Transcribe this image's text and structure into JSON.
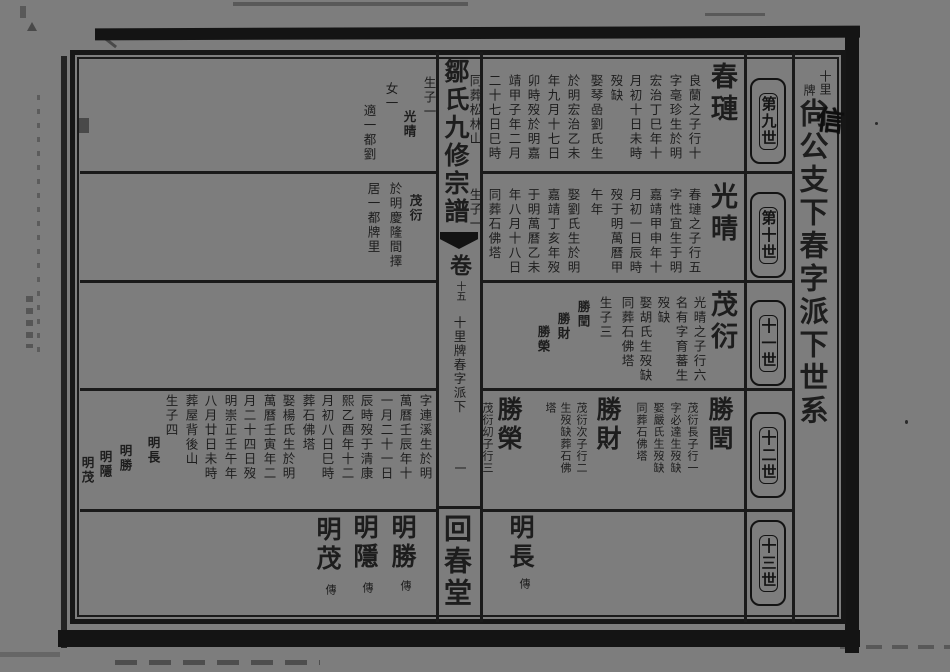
{
  "colors": {
    "paper": "#7d7d7d",
    "ink": "#1c1c1c"
  },
  "header": {
    "small_line1": "十里",
    "small_line2": "牌",
    "title": "尙公支下春字派下世系",
    "handwritten_note": "信"
  },
  "generation_labels": [
    "第九世",
    "第十世",
    "十一世",
    "十二世",
    "十三世"
  ],
  "fold": {
    "book_title": "鄒氏九修宗譜",
    "volume_label": "卷",
    "volume_number": "十五",
    "section": "十里牌春字派下",
    "page_number": "一",
    "hall": "回春堂"
  },
  "right_page": {
    "band1": {
      "name": "春璉",
      "columns": [
        "良蘭之子行十",
        "字亳珍生於明",
        "宏治丁巳年十",
        "月初十日未時",
        "歿缺",
        "娶琴嵒劉氏生",
        "於明宏治乙未",
        "年九月十七日",
        "卯時歿於明嘉",
        "靖甲子年二月",
        "二十七日巳時",
        "同葬松林山"
      ]
    },
    "band2": {
      "name": "光晴",
      "columns": [
        "春璉之子行五",
        "字性宜生于明",
        "嘉靖甲申年十",
        "月初一日辰時",
        "歿于明萬曆甲",
        "午年",
        "娶劉氏生於明",
        "嘉靖丁亥年歿",
        "于明萬曆乙未",
        "年八月十八日",
        "同葬石佛塔",
        "生子一"
      ]
    },
    "band3": {
      "name": "茂衍",
      "columns": [
        "光晴之子行六",
        "名有字育蕃生",
        "歿缺",
        "娶胡氏生歿缺",
        "同葬石佛塔",
        "生子三"
      ],
      "sons": [
        "勝閏",
        "勝財",
        "勝榮"
      ]
    },
    "band4": {
      "entries": [
        {
          "name": "勝閏",
          "columns": [
            "茂衍長子行一",
            "字必達生歿缺",
            "娶嚴氏生歿缺",
            "同葬石佛塔"
          ]
        },
        {
          "name": "勝財",
          "columns": [
            "茂衍次子行二",
            "生歿缺葬石佛",
            "塔"
          ]
        },
        {
          "name": "勝榮",
          "columns": [
            "茂衍㓜子行三"
          ]
        }
      ]
    },
    "band5": {
      "name": "明長",
      "marker": "傳"
    }
  },
  "left_page": {
    "band1": {
      "columns": [
        "生子一",
        "光晴",
        "女一",
        "適一都劉"
      ]
    },
    "band2": {
      "columns": [
        "茂衍",
        "於明慶隆間擇",
        "居一都牌里"
      ]
    },
    "band4": {
      "columns": [
        "字連溪生於明",
        "萬曆壬辰年十",
        "一月二十一日",
        "辰時歿于清康",
        "熙乙酉年十二",
        "月初八日巳時",
        "葬石佛塔",
        "娶楊氏生於明",
        "萬曆壬寅年二",
        "月二十四日歿",
        "明崇正壬午年",
        "八月廿日未時",
        "葬屋背後山",
        "生子四"
      ],
      "sons": [
        "明長",
        "明勝",
        "明隱",
        "明茂"
      ]
    },
    "band5": {
      "entries": [
        {
          "name": "明勝",
          "marker": "傳"
        },
        {
          "name": "明隱",
          "marker": "傳"
        },
        {
          "name": "明茂",
          "marker": "傳"
        }
      ]
    }
  }
}
